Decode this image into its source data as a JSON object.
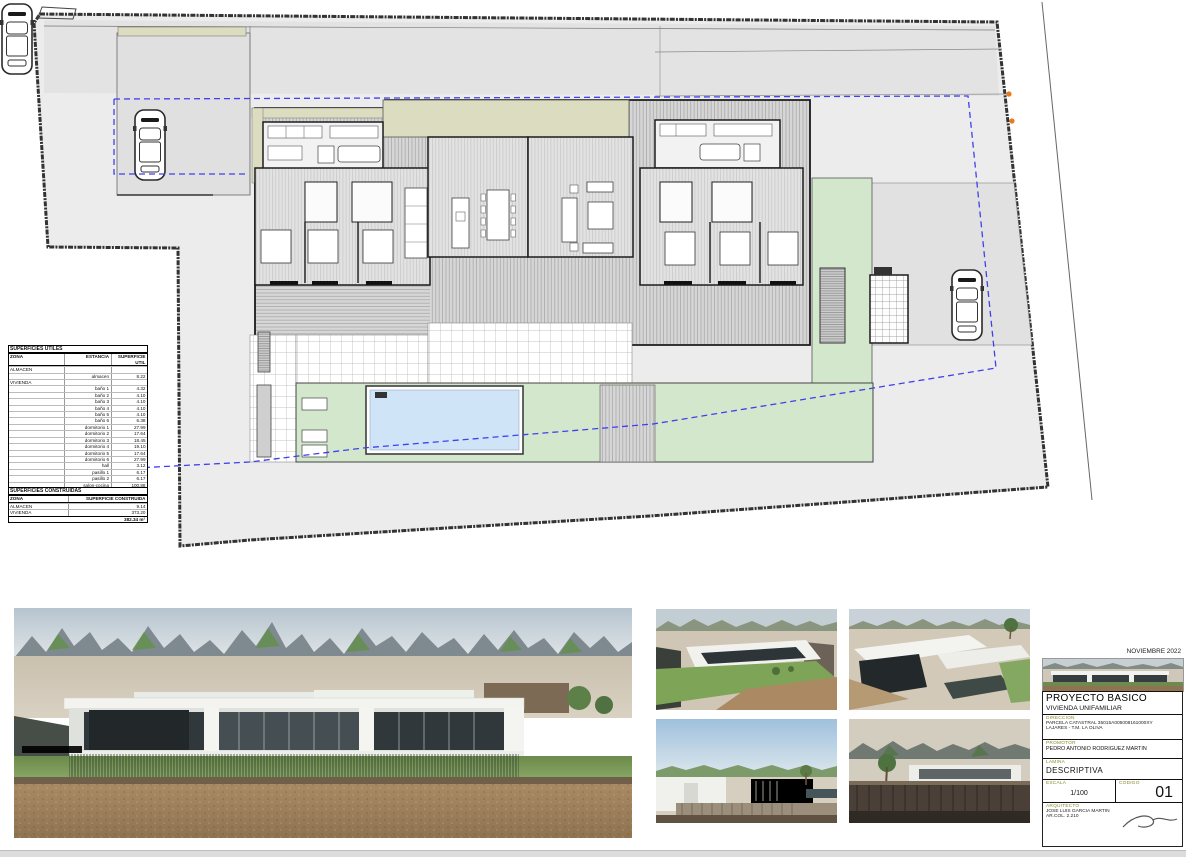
{
  "date": "NOVIEMBRE 2022",
  "tables": {
    "utiles": {
      "title": "SUPERFICIES UTILES",
      "headers": [
        "ZONA",
        "ESTANCIA",
        "SUPERFICIE UTIL"
      ],
      "rows": [
        {
          "z": "ALMACEN",
          "e": "",
          "s": ""
        },
        {
          "z": "",
          "e": "almacen",
          "s": "8.22"
        },
        {
          "z": "VIVIENDA",
          "e": "",
          "s": ""
        },
        {
          "z": "",
          "e": "baño 1",
          "s": "4.32"
        },
        {
          "z": "",
          "e": "baño 2",
          "s": "4.10"
        },
        {
          "z": "",
          "e": "baño 3",
          "s": "4.10"
        },
        {
          "z": "",
          "e": "baño 4",
          "s": "4.10"
        },
        {
          "z": "",
          "e": "baño 5",
          "s": "4.10"
        },
        {
          "z": "",
          "e": "baño 6",
          "s": "6.38"
        },
        {
          "z": "",
          "e": "dormitorio 1",
          "s": "27.99"
        },
        {
          "z": "",
          "e": "dormitorio 2",
          "s": "17.64"
        },
        {
          "z": "",
          "e": "dormitorio 3",
          "s": "18.45"
        },
        {
          "z": "",
          "e": "dormitorio 4",
          "s": "19.10"
        },
        {
          "z": "",
          "e": "dormitorio 5",
          "s": "17.64"
        },
        {
          "z": "",
          "e": "dormitorio 6",
          "s": "27.99"
        },
        {
          "z": "",
          "e": "hall",
          "s": "3.12"
        },
        {
          "z": "",
          "e": "pasillo 1",
          "s": "6.17"
        },
        {
          "z": "",
          "e": "pasillo 2",
          "s": "6.17"
        },
        {
          "z": "",
          "e": "salon-cocina",
          "s": "100.88"
        },
        {
          "z": "",
          "e": "vestidor 1",
          "s": "7.07"
        },
        {
          "z": "",
          "e": "vestidor 2",
          "s": "7.07"
        }
      ],
      "total": "282.67 m²"
    },
    "construidas": {
      "title": "SUPERFICIES CONSTRUIDAS",
      "headers": [
        "ZONA",
        "SUPERFICIE CONSTRUIDA"
      ],
      "rows": [
        {
          "z": "ALMACEN",
          "s": "9.14"
        },
        {
          "z": "VIVIENDA",
          "s": "373.20"
        }
      ],
      "total": "382.34 m²"
    }
  },
  "titleblock": {
    "project_title": "PROYECTO BASICO",
    "project_subtitle": "VIVIENDA UNIFAMILIAR",
    "direccion_label": "DIRECCION",
    "direccion_line1": "PARCELA CATASTRAL 35015A005008161000XY",
    "direccion_line2": "LAJARES - T.M. LA OLIVA",
    "promotor_label": "PROMOTOR",
    "promotor_name": "PEDRO ANTONIO RODRIGUEZ MARTIN",
    "lamina_label": "LAMINA",
    "lamina_value": "DESCRIPTIVA",
    "escala_label": "ESCALA",
    "escala_value": "1/100",
    "codigo_label": "CODIGO",
    "codigo_value": "01",
    "arquitecto_label": "ARQUITECTO",
    "arquitecto_name": "JOSE LUIS GARCIA MARTIN",
    "arquitecto_col": "AR.COL. 2.210"
  },
  "colors": {
    "parcel_gray": "#ececec",
    "band_gray": "#e3e3e3",
    "khaki": "#dcdcc0",
    "garden_green": "#d3e7cc",
    "pool_blue": "#cfe4f7",
    "setback_blue": "#4040ee",
    "marker_orange": "#e87a20",
    "label_olive": "#8a8a2a"
  }
}
